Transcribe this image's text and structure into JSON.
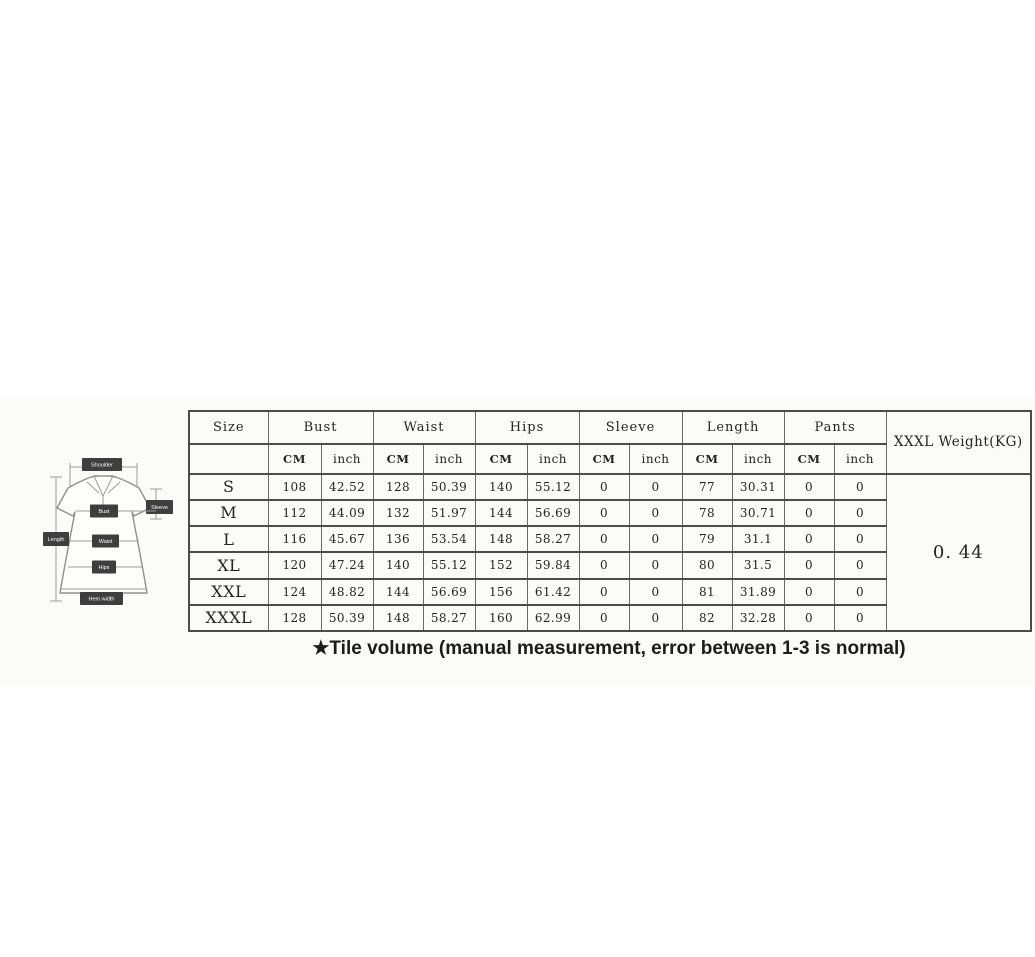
{
  "table": {
    "size_header": "Size",
    "group_headers": [
      "Bust",
      "Waist",
      "Hips",
      "Sleeve",
      "Length",
      "Pants"
    ],
    "unit_cm": "CM",
    "unit_inch": "inch",
    "weight_header": "XXXL Weight(KG)",
    "weight_value": "0. 44",
    "rows": [
      {
        "size": "S",
        "bust_cm": "108",
        "bust_in": "42.52",
        "waist_cm": "128",
        "waist_in": "50.39",
        "hips_cm": "140",
        "hips_in": "55.12",
        "sleeve_cm": "0",
        "sleeve_in": "0",
        "length_cm": "77",
        "length_in": "30.31",
        "pants_cm": "0",
        "pants_in": "0"
      },
      {
        "size": "M",
        "bust_cm": "112",
        "bust_in": "44.09",
        "waist_cm": "132",
        "waist_in": "51.97",
        "hips_cm": "144",
        "hips_in": "56.69",
        "sleeve_cm": "0",
        "sleeve_in": "0",
        "length_cm": "78",
        "length_in": "30.71",
        "pants_cm": "0",
        "pants_in": "0"
      },
      {
        "size": "L",
        "bust_cm": "116",
        "bust_in": "45.67",
        "waist_cm": "136",
        "waist_in": "53.54",
        "hips_cm": "148",
        "hips_in": "58.27",
        "sleeve_cm": "0",
        "sleeve_in": "0",
        "length_cm": "79",
        "length_in": "31.1",
        "pants_cm": "0",
        "pants_in": "0"
      },
      {
        "size": "XL",
        "bust_cm": "120",
        "bust_in": "47.24",
        "waist_cm": "140",
        "waist_in": "55.12",
        "hips_cm": "152",
        "hips_in": "59.84",
        "sleeve_cm": "0",
        "sleeve_in": "0",
        "length_cm": "80",
        "length_in": "31.5",
        "pants_cm": "0",
        "pants_in": "0"
      },
      {
        "size": "XXL",
        "bust_cm": "124",
        "bust_in": "48.82",
        "waist_cm": "144",
        "waist_in": "56.69",
        "hips_cm": "156",
        "hips_in": "61.42",
        "sleeve_cm": "0",
        "sleeve_in": "0",
        "length_cm": "81",
        "length_in": "31.89",
        "pants_cm": "0",
        "pants_in": "0"
      },
      {
        "size": "XXXL",
        "bust_cm": "128",
        "bust_in": "50.39",
        "waist_cm": "148",
        "waist_in": "58.27",
        "hips_cm": "160",
        "hips_in": "62.99",
        "sleeve_cm": "0",
        "sleeve_in": "0",
        "length_cm": "82",
        "length_in": "32.28",
        "pants_cm": "0",
        "pants_in": "0"
      }
    ]
  },
  "note": "★Tile volume (manual measurement, error between 1-3 is normal)",
  "diagram": {
    "labels": {
      "shoulder": "Shoulder",
      "sleeve": "Sleeve",
      "length": "Length",
      "bust": "Bust",
      "waist": "Waist",
      "hips": "Hips",
      "hem": "Hem width"
    }
  },
  "colors": {
    "table_border": "#4c4c4c",
    "label_box": "#3e3e3e",
    "note_text": "#1c1c1c",
    "background": "#ffffff"
  }
}
